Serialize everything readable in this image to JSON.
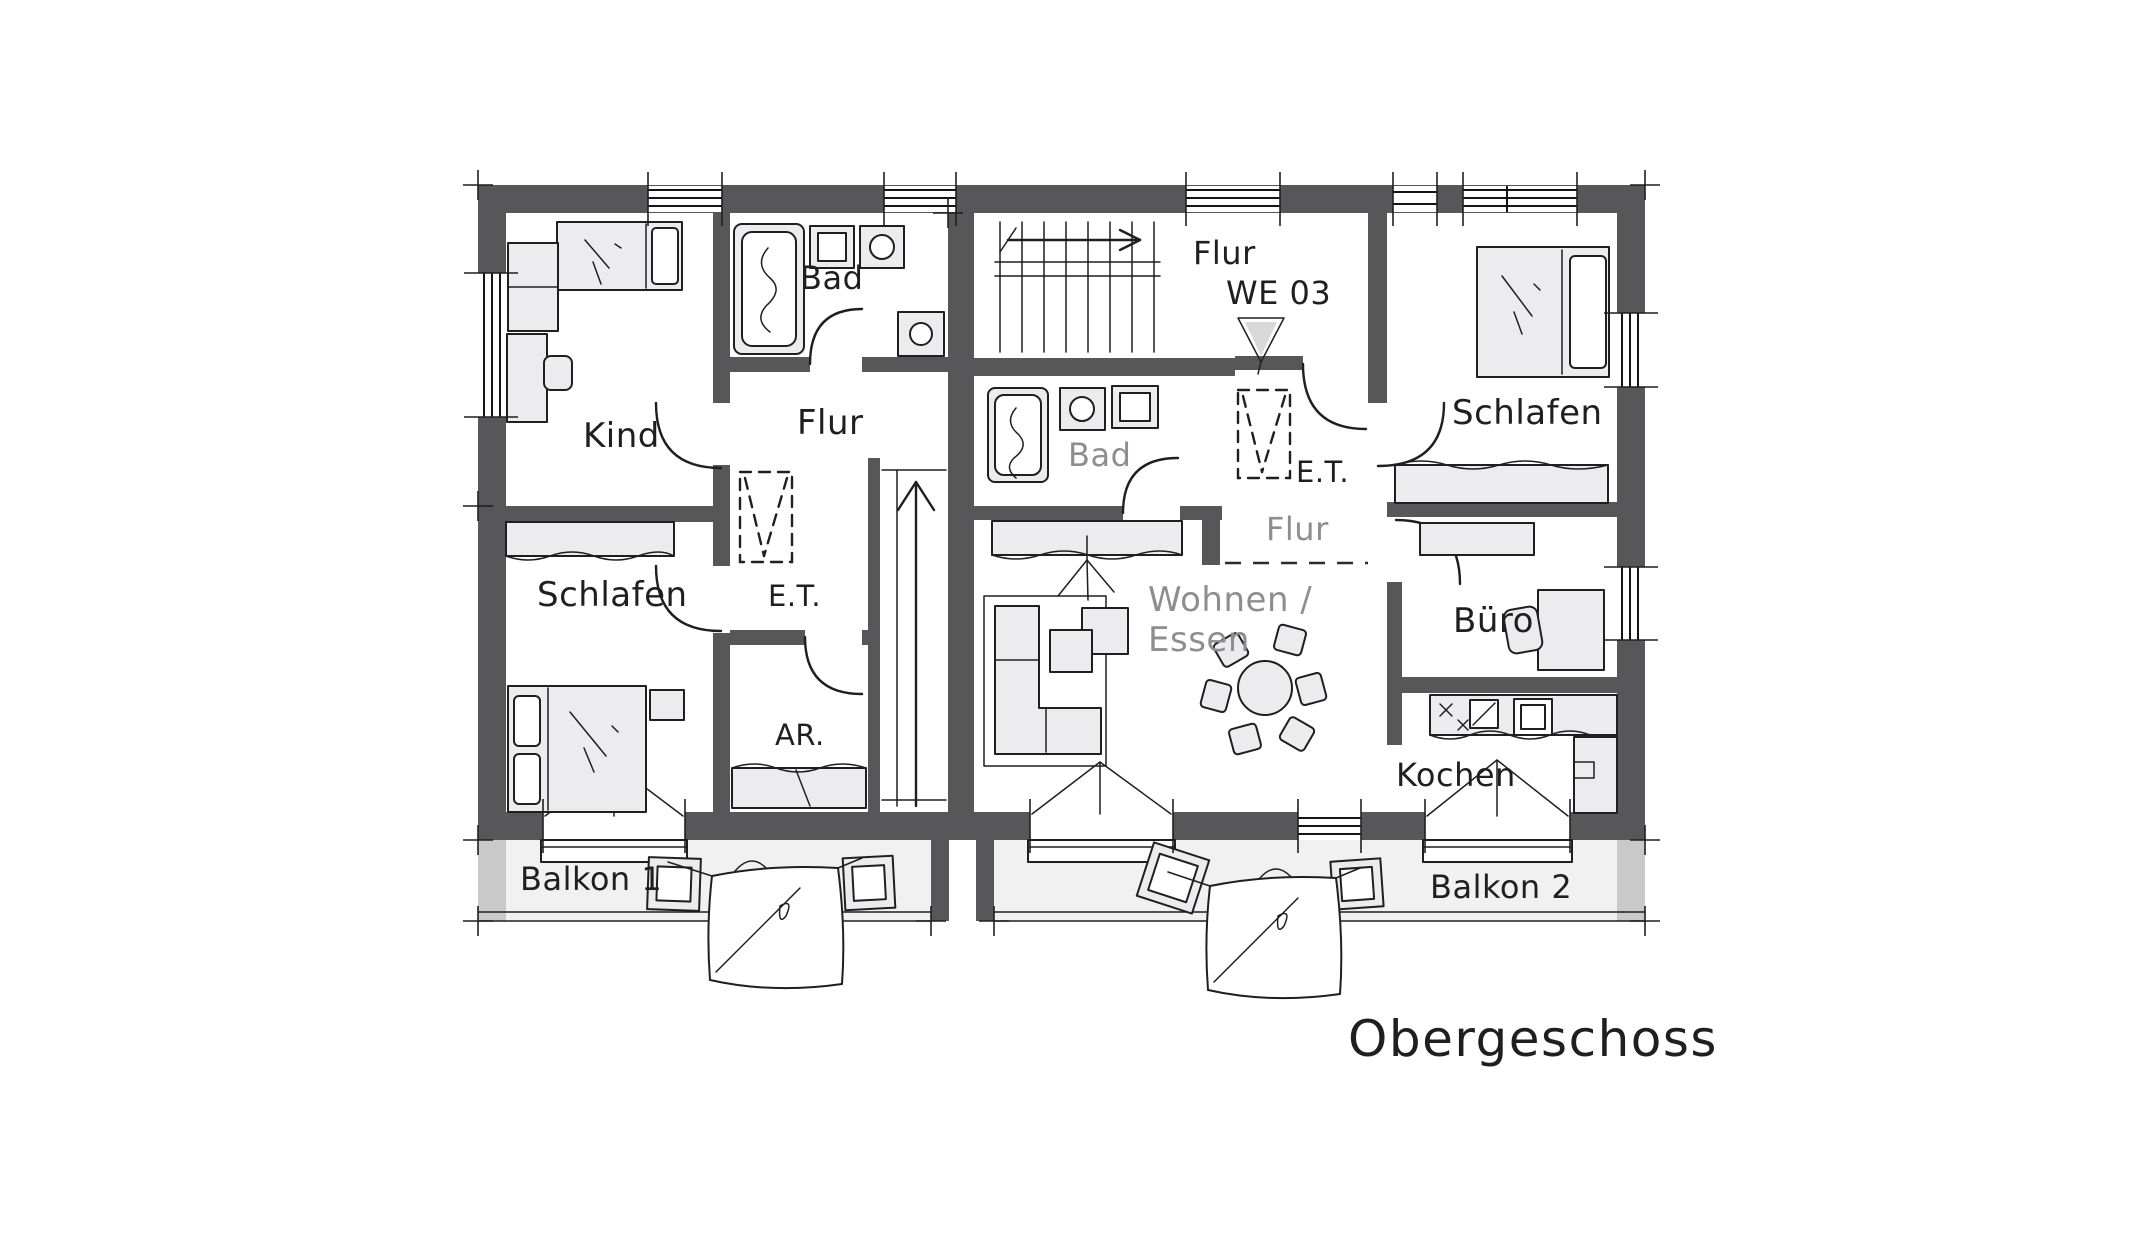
{
  "title": "Obergeschoss",
  "colors": {
    "wall": "#57575a",
    "furniture_fill": "#ececee",
    "balcony_fill": "#f1f1f2",
    "wall_end_cap": "#c9c9ca",
    "line": "#1f1f1f",
    "label_dark": "#1f1f1f",
    "label_gray": "#8e8e8e",
    "entrance_triangle_fill": "#d9d9db",
    "background": "#ffffff"
  },
  "unit_tag": {
    "corridor": "Flur",
    "unit_id": "WE 03"
  },
  "apartment_left": {
    "kind": "Kind",
    "bad": "Bad",
    "flur": "Flur",
    "schlafen": "Schlafen",
    "wardrobe_abbr": "E.T.",
    "storage_abbr": "AR.",
    "balcony": "Balkon 1"
  },
  "apartment_right": {
    "bad": "Bad",
    "wardrobe_abbr": "E.T.",
    "flur": "Flur",
    "schlafen": "Schlafen",
    "office": "Büro",
    "living": "Wohnen /",
    "dining": "Essen",
    "kitchen": "Kochen",
    "balcony": "Balkon 2"
  }
}
